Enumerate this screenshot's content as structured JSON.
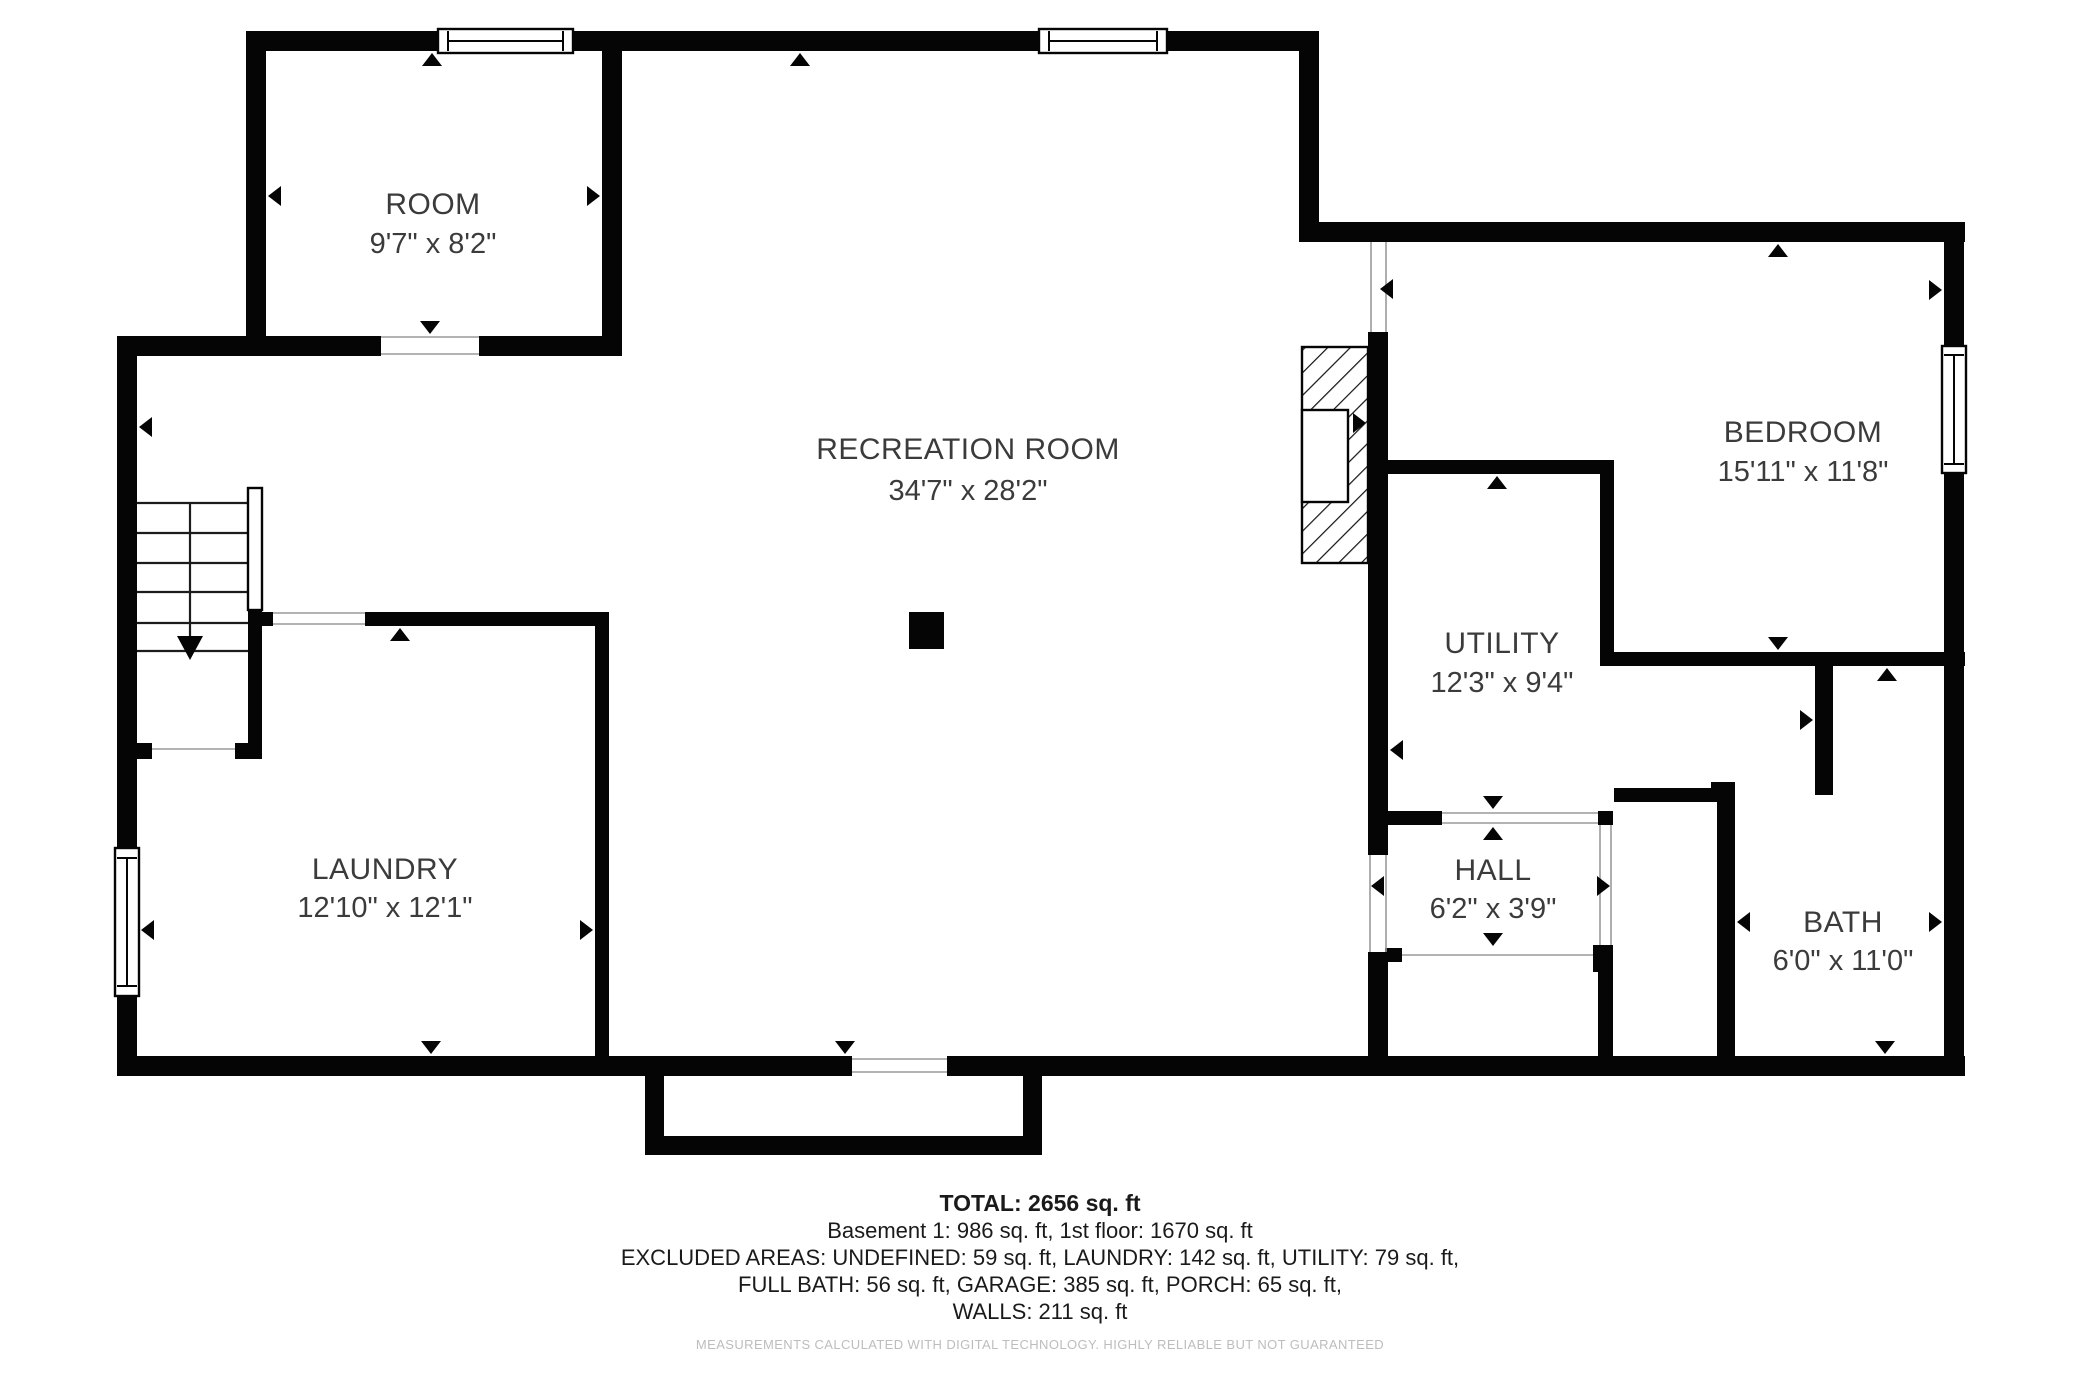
{
  "floor_plan": {
    "rooms": [
      {
        "name": "ROOM",
        "dimensions": "9'7\" x 8'2\""
      },
      {
        "name": "RECREATION ROOM",
        "dimensions": "34'7\" x 28'2\""
      },
      {
        "name": "BEDROOM",
        "dimensions": "15'11\" x 11'8\""
      },
      {
        "name": "UTILITY",
        "dimensions": "12'3\" x 9'4\""
      },
      {
        "name": "LAUNDRY",
        "dimensions": "12'10\" x 12'1\""
      },
      {
        "name": "HALL",
        "dimensions": "6'2\" x 3'9\""
      },
      {
        "name": "BATH",
        "dimensions": "6'0\" x 11'0\""
      }
    ],
    "summary": {
      "total": "TOTAL: 2656 sq. ft",
      "line1": "Basement 1: 986 sq. ft, 1st floor: 1670 sq. ft",
      "line2": "EXCLUDED AREAS: UNDEFINED: 59 sq. ft, LAUNDRY: 142 sq. ft, UTILITY: 79 sq. ft,",
      "line3": "FULL BATH: 56 sq. ft, GARAGE: 385 sq. ft, PORCH: 65 sq. ft,",
      "line4": "WALLS: 211 sq. ft",
      "disclaimer": "MEASUREMENTS CALCULATED WITH DIGITAL TECHNOLOGY. HIGHLY RELIABLE BUT NOT GUARANTEED"
    },
    "colors": {
      "wall": "#050505",
      "label_text": "#3b3b3b",
      "summary_text": "#1a1a1a",
      "disclaimer_text": "#bdbdbd",
      "door_line": "#9a9a9a"
    }
  }
}
